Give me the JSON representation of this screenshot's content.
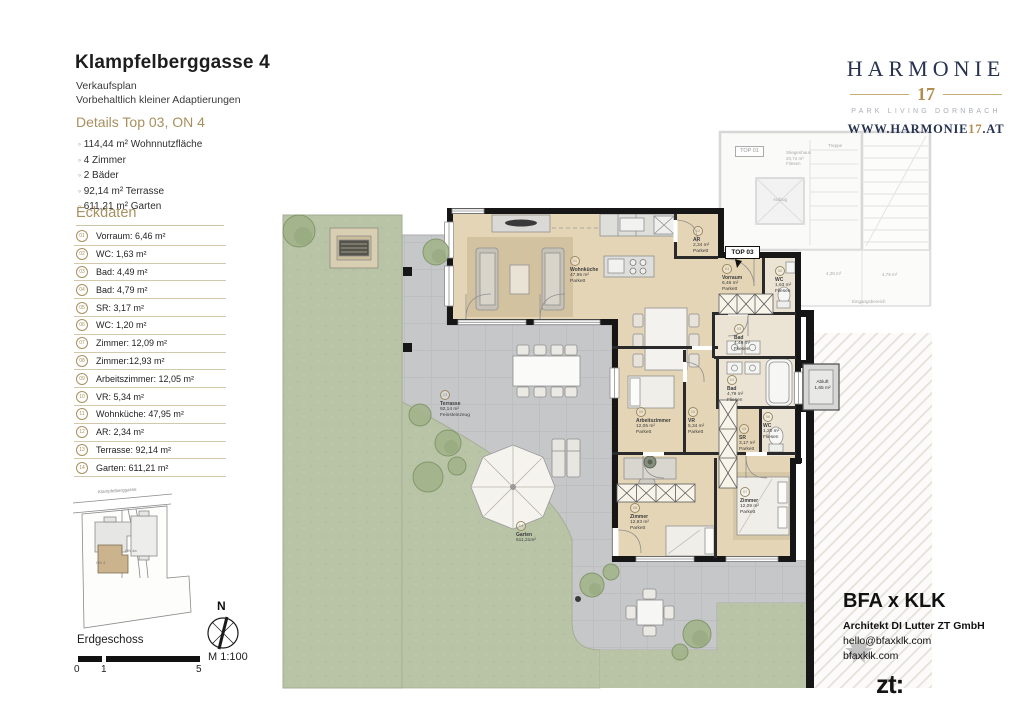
{
  "header": {
    "title": "Klampfelberggasse 4",
    "subtitle": "Verkaufsplan",
    "note": "Vorbehaltlich kleiner Adaptierungen"
  },
  "details": {
    "heading": "Details Top 03, ON 4",
    "items": [
      "114,44 m² Wohnnutzfläche",
      "4 Zimmer",
      "2 Bäder",
      "92,14 m² Terrasse",
      "611,21 m² Garten"
    ]
  },
  "eckdaten": {
    "heading": "Eckdaten",
    "rows": [
      {
        "num": "01",
        "label": "Vorraum: 6,46 m²"
      },
      {
        "num": "02",
        "label": "WC: 1,63 m²"
      },
      {
        "num": "03",
        "label": "Bad: 4,49 m²"
      },
      {
        "num": "04",
        "label": "Bad: 4,79 m²"
      },
      {
        "num": "05",
        "label": "SR: 3,17 m²"
      },
      {
        "num": "06",
        "label": "WC: 1,20 m²"
      },
      {
        "num": "07",
        "label": "Zimmer: 12,09 m²"
      },
      {
        "num": "08",
        "label": "Zimmer:12,93 m²"
      },
      {
        "num": "09",
        "label": "Arbeitszimmer: 12,05 m²"
      },
      {
        "num": "10",
        "label": "VR: 5,34 m²"
      },
      {
        "num": "11",
        "label": "Wohnküche: 47,95 m²"
      },
      {
        "num": "12",
        "label": "AR: 2,34 m²"
      },
      {
        "num": "13",
        "label": "Terrasse: 92,14 m²"
      },
      {
        "num": "14",
        "label": "Garten: 611,21 m²"
      }
    ]
  },
  "site": {
    "street": "Klampfelberggasse",
    "building_a": "ON 4",
    "building_b": "ON 4a",
    "floor": "Erdgeschoss",
    "north": "N",
    "scale_label": "M 1:100",
    "scale_marks": [
      "0",
      "1",
      "5"
    ]
  },
  "brand": {
    "name": "HARMONIE",
    "number": "17",
    "tagline": "PARK LIVING DORNBACH",
    "site_pre": "WWW.HARMONIE",
    "site_num": "17",
    "site_post": ".AT",
    "navy": "#26324f",
    "gold": "#b28d4f"
  },
  "architect": {
    "name": "BFA x KLK",
    "firm": "Architekt DI Lutter ZT GmbH",
    "email": "hello@bfaxklk.com",
    "web": "bfaxklk.com",
    "zt": "zt:"
  },
  "floorplan": {
    "unit": "TOP 03",
    "rooms": [
      {
        "num": "01",
        "name": "Vorraum",
        "area": "6,46 m²",
        "floor": "Parkett"
      },
      {
        "num": "02",
        "name": "WC",
        "area": "1,63 m²",
        "floor": "Fliesen"
      },
      {
        "num": "03",
        "name": "Bad",
        "area": "4,49 m²",
        "floor": "Fliesen"
      },
      {
        "num": "04",
        "name": "Bad",
        "area": "4,79 m²",
        "floor": "Fliesen"
      },
      {
        "num": "05",
        "name": "SR",
        "area": "3,17 m²",
        "floor": "Parkett"
      },
      {
        "num": "06",
        "name": "WC",
        "area": "1,20 m²",
        "floor": "Fliesen"
      },
      {
        "num": "07",
        "name": "Zimmer",
        "area": "12,09 m²",
        "floor": "Parkett"
      },
      {
        "num": "08",
        "name": "Zimmer",
        "area": "12,93 m²",
        "floor": "Parkett"
      },
      {
        "num": "09",
        "name": "Arbeitszimmer",
        "area": "12,05 m²",
        "floor": "Parkett"
      },
      {
        "num": "10",
        "name": "VR",
        "area": "5,34 m²",
        "floor": "Parkett"
      },
      {
        "num": "11",
        "name": "Wohnküche",
        "area": "47,95 m²",
        "floor": "Parkett"
      },
      {
        "num": "12",
        "name": "AR",
        "area": "2,34 m²",
        "floor": "Parkett"
      },
      {
        "num": "13",
        "name": "Terrasse",
        "area": "92,14 m²",
        "floor": "Feinsteinzeug"
      },
      {
        "num": "14",
        "name": "Garten",
        "area": "611,21m²",
        "floor": ""
      }
    ],
    "abluft": {
      "name": "Abluft",
      "area": "1,65 m²"
    },
    "neighbor": {
      "unit": "TOP 01",
      "stiegenhaus": "Stiegenhaus",
      "stiegenhaus_area": "20,74 m²",
      "stiegenhaus_floor": "Fliesen",
      "treppe": "Treppe",
      "aufzug": "Aufzug",
      "eingang": "Eingangsbereich",
      "area_a": "4,28 m²",
      "area_b": "4,79 m²"
    }
  }
}
